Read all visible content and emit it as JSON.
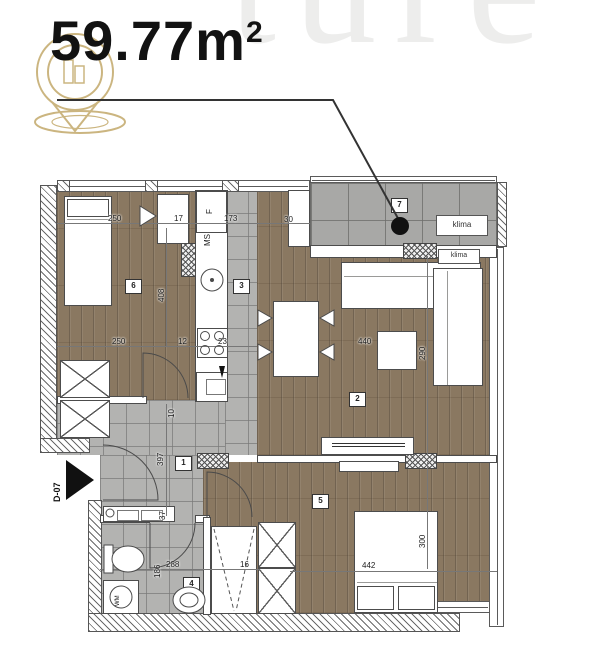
{
  "header": {
    "area": "59.77m",
    "area_exponent": "2"
  },
  "watermark": {
    "letters": "ture"
  },
  "entry": {
    "door_code": "D-07"
  },
  "room_labels": {
    "hall": "1",
    "living_room": "2",
    "kitchen": "3",
    "bathroom": "4",
    "bedroom_2": "5",
    "bedroom_1": "6",
    "terrace": "7"
  },
  "appliance_labels": {
    "klima_terrace": "klima",
    "klima_living": "klima",
    "fridge": "F",
    "kitchen_unit": "MS",
    "washing_machine": "WM"
  },
  "dimensions": {
    "bed1_top_250": "250",
    "top_17": "17",
    "top_173": "173",
    "top_30": "30",
    "bed1_mid_250": "250",
    "mid_12": "12",
    "mid_23": "23",
    "bed1_depth_408": "408",
    "living_width_440": "440",
    "living_depth_290": "290",
    "hall_depth_397": "397",
    "hall_37": "37",
    "hall_10": "10",
    "bath_depth_186": "186",
    "bath_width_288": "288",
    "bath_16": "16",
    "bed2_width_442": "442",
    "bed2_depth_300": "300"
  },
  "colors": {
    "accent_gold": "#c9b27a",
    "wood": "#8a7861",
    "tile": "#b3b3b1",
    "terrace": "#a8a8a6",
    "line": "#3d3d3d",
    "text": "#121212"
  }
}
